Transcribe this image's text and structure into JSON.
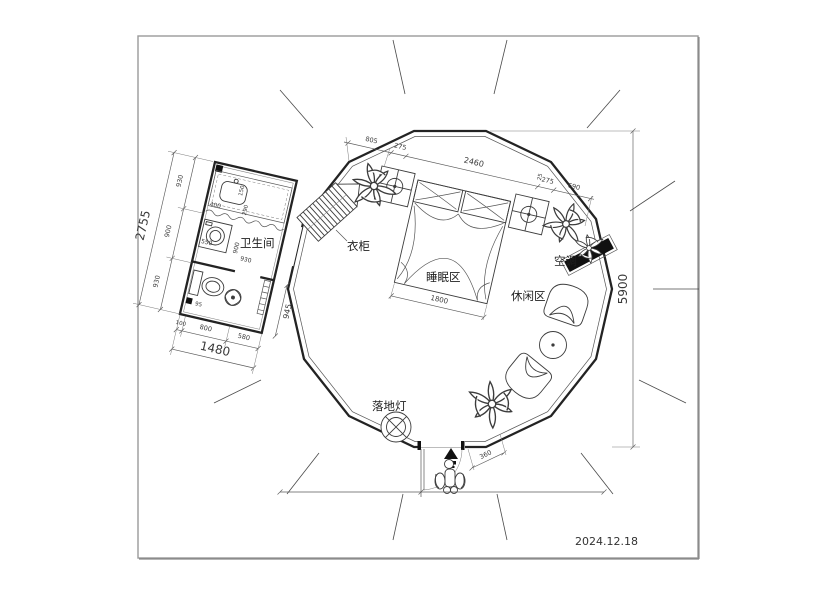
{
  "meta": {
    "date": "2024.12.18"
  },
  "labels": {
    "bathroom": "卫生间",
    "wardrobe": "衣柜",
    "sleeping_area": "睡眠区",
    "leisure_area": "休闲区",
    "air_conditioner": "空调",
    "floor_lamp": "落地灯"
  },
  "dims": {
    "overall_height": "5900",
    "bed_width": "1800",
    "entry_segment": "360",
    "top_chain": [
      "805",
      "275",
      "2460",
      "25",
      "275",
      "690"
    ],
    "bath": {
      "left_total": "2755",
      "left_chain": [
        "930",
        "900",
        "930"
      ],
      "bottom_total": "1480",
      "bottom_chain": [
        "100",
        "800",
        "580"
      ],
      "right_side": "945",
      "inner": {
        "vanity": "400",
        "d1": "150",
        "d2": "290",
        "washer": "550",
        "w1": "900",
        "w2": "930",
        "corner": "95"
      }
    }
  },
  "colors": {
    "line": "#232323",
    "thin": "#565656",
    "fill_dark": "#111111",
    "border": "#9a9a9a",
    "text": "#3a3a3a"
  }
}
